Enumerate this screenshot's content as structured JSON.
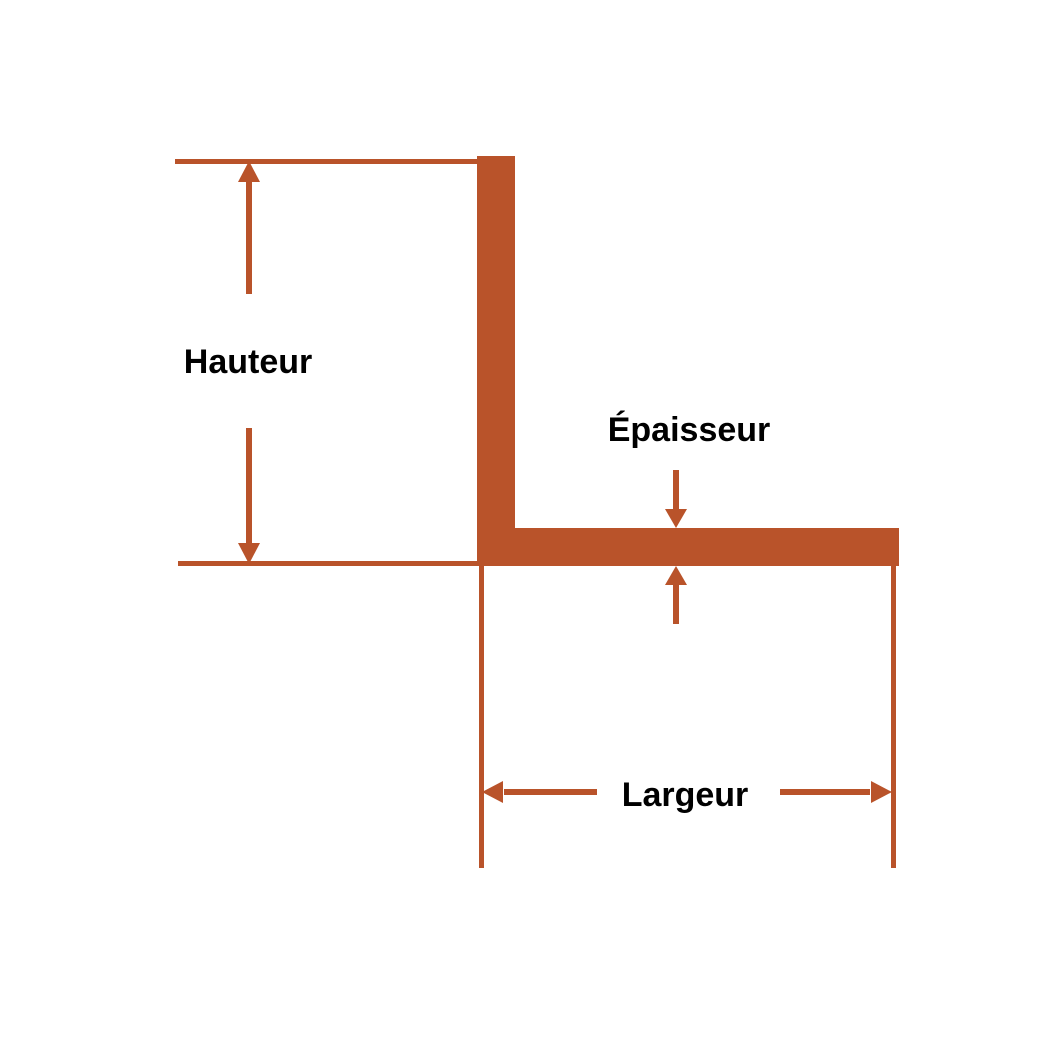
{
  "diagram": {
    "subject": "angle-profile-dimension-diagram",
    "labels": {
      "hauteur": "Hauteur",
      "epaisseur": "Épaisseur",
      "largeur": "Largeur"
    },
    "colors": {
      "accent": "#B9532A",
      "text": "#000000",
      "background": "#FFFFFF"
    }
  }
}
